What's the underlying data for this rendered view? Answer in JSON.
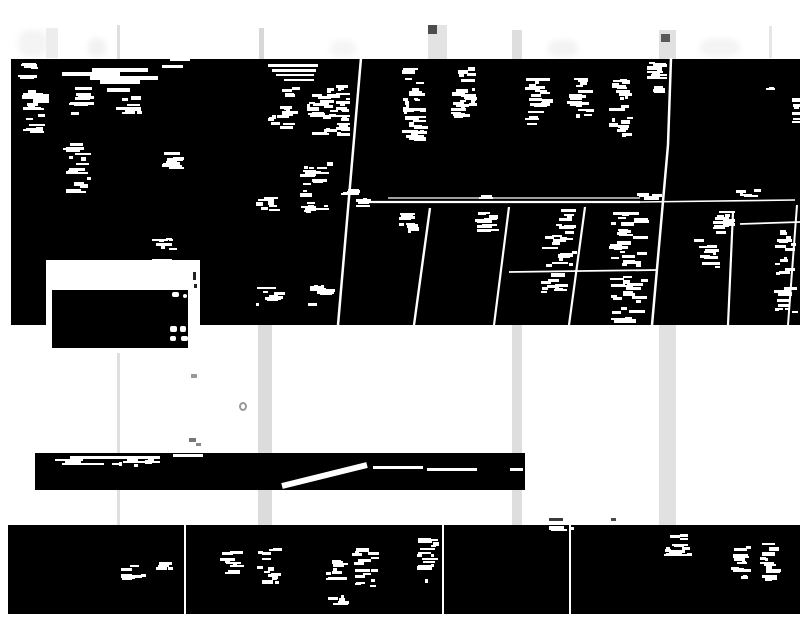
{
  "meta": {
    "description": "Heavily binarized (black and white thresholded) photograph: black bands with illegible white text-remnant speckles, gray vertical poles, a white sign with black panel, slanted white divider lines",
    "width": 800,
    "height": 618
  },
  "palette": {
    "background": "#ffffff",
    "foreground": "#000000",
    "detail": "#ffffff",
    "pole_light": "#e0e0e0",
    "cap_dark": "#4d4d4d"
  },
  "black_blocks": [
    {
      "name": "black-band-main",
      "x": 11,
      "y": 59,
      "w": 789,
      "h": 266
    },
    {
      "name": "black-bar-middle",
      "x": 35,
      "y": 453,
      "w": 490,
      "h": 37
    },
    {
      "name": "black-band-bottom",
      "x": 8,
      "y": 525,
      "w": 792,
      "h": 89
    }
  ],
  "poles": [
    {
      "x": 46,
      "y": 28,
      "w": 12,
      "h": 30,
      "color": "#ededed"
    },
    {
      "x": 117,
      "y": 25,
      "w": 3,
      "h": 589,
      "color": "#dfdfdf"
    },
    {
      "x": 259,
      "y": 28,
      "w": 5,
      "h": 31,
      "color": "#d8d8d8"
    },
    {
      "x": 258,
      "y": 325,
      "w": 14,
      "h": 289,
      "color": "#dcdcdc"
    },
    {
      "x": 428,
      "y": 25,
      "w": 19,
      "h": 34,
      "color": "#e3e3e3"
    },
    {
      "x": 512,
      "y": 30,
      "w": 10,
      "h": 584,
      "color": "#dedede"
    },
    {
      "x": 659,
      "y": 30,
      "w": 17,
      "h": 584,
      "color": "#e1e1e1"
    },
    {
      "x": 769,
      "y": 26,
      "w": 3,
      "h": 32,
      "color": "#e6e6e6"
    }
  ],
  "pole_caps": [
    {
      "x": 428,
      "y": 25,
      "w": 9,
      "h": 9,
      "color": "#4d4d4d"
    },
    {
      "x": 661,
      "y": 34,
      "w": 9,
      "h": 8,
      "color": "#5a5a5a"
    }
  ],
  "smudges": [
    {
      "x": 18,
      "y": 30,
      "w": 30,
      "h": 27,
      "color": "#f4f4f4"
    },
    {
      "x": 88,
      "y": 38,
      "w": 18,
      "h": 19,
      "color": "#f2f2f2"
    },
    {
      "x": 330,
      "y": 40,
      "w": 26,
      "h": 17,
      "color": "#f5f5f5"
    },
    {
      "x": 548,
      "y": 40,
      "w": 30,
      "h": 17,
      "color": "#f3f3f3"
    },
    {
      "x": 700,
      "y": 38,
      "w": 40,
      "h": 19,
      "color": "#f4f4f4"
    }
  ],
  "sign": {
    "panel": {
      "x": 46,
      "y": 260,
      "w": 154,
      "h": 93
    },
    "inner": {
      "x": 52,
      "y": 290,
      "w": 136,
      "h": 58
    },
    "white_glyphs": [
      [
        172,
        292,
        7,
        5
      ],
      [
        183,
        294,
        4,
        4
      ],
      [
        170,
        326,
        7,
        6
      ],
      [
        180,
        326,
        6,
        6
      ],
      [
        170,
        336,
        6,
        5
      ],
      [
        181,
        336,
        7,
        5
      ]
    ],
    "dark_marks": [
      [
        193,
        272,
        3,
        8
      ],
      [
        194,
        284,
        3,
        4
      ]
    ]
  },
  "white_lines": [
    [
      361,
      58,
      338,
      325,
      2.5
    ],
    [
      671,
      58,
      668,
      145,
      2.5
    ],
    [
      668,
      145,
      652,
      325,
      2.5
    ],
    [
      358,
      202,
      640,
      202,
      2.2
    ],
    [
      388,
      198,
      640,
      198,
      1.2
    ],
    [
      640,
      202,
      795,
      200,
      1.6
    ],
    [
      509,
      272,
      657,
      270,
      1.8
    ],
    [
      740,
      224,
      800,
      222,
      1.8
    ],
    [
      430,
      208,
      414,
      325,
      2.4
    ],
    [
      509,
      207,
      494,
      325,
      2.2
    ],
    [
      585,
      207,
      569,
      325,
      2.2
    ],
    [
      733,
      212,
      728,
      325,
      2.2
    ],
    [
      797,
      205,
      788,
      325,
      2.0
    ],
    [
      282,
      486,
      367,
      465,
      6.0
    ],
    [
      185,
      525,
      185,
      614,
      2.0
    ],
    [
      443,
      525,
      443,
      614,
      2.0
    ],
    [
      570,
      525,
      570,
      614,
      2.0
    ]
  ],
  "white_streaks": [
    [
      92,
      68,
      56,
      4
    ],
    [
      62,
      72,
      58,
      4
    ],
    [
      90,
      76,
      68,
      4
    ],
    [
      100,
      80,
      40,
      4
    ],
    [
      75,
      87,
      17,
      3
    ],
    [
      107,
      88,
      23,
      4
    ],
    [
      162,
      65,
      21,
      3
    ],
    [
      170,
      58,
      20,
      3
    ],
    [
      268,
      64,
      50,
      3
    ],
    [
      272,
      69,
      44,
      3
    ],
    [
      276,
      74,
      38,
      2
    ],
    [
      284,
      79,
      30,
      2
    ],
    [
      70,
      456,
      90,
      3
    ],
    [
      55,
      459,
      28,
      2
    ],
    [
      123,
      461,
      37,
      2
    ],
    [
      62,
      463,
      42,
      2
    ],
    [
      173,
      454,
      30,
      3
    ],
    [
      373,
      466,
      50,
      3
    ],
    [
      427,
      468,
      50,
      3
    ],
    [
      510,
      468,
      13,
      3
    ],
    [
      152,
      259,
      20,
      3
    ],
    [
      176,
      261,
      12,
      2
    ],
    [
      150,
      264,
      24,
      2
    ]
  ],
  "speckle_clusters": [
    [
      14,
      62,
      28,
      18,
      9
    ],
    [
      22,
      90,
      27,
      43,
      22
    ],
    [
      68,
      93,
      26,
      27,
      13
    ],
    [
      116,
      94,
      28,
      26,
      13
    ],
    [
      23,
      128,
      25,
      6,
      3
    ],
    [
      63,
      142,
      28,
      52,
      20
    ],
    [
      159,
      151,
      26,
      20,
      9
    ],
    [
      250,
      197,
      30,
      16,
      8
    ],
    [
      300,
      197,
      29,
      16,
      8
    ],
    [
      152,
      235,
      27,
      15,
      8
    ],
    [
      150,
      258,
      26,
      11,
      6
    ],
    [
      255,
      286,
      30,
      21,
      10
    ],
    [
      306,
      284,
      31,
      23,
      10
    ],
    [
      266,
      99,
      33,
      33,
      15
    ],
    [
      282,
      83,
      18,
      15,
      6
    ],
    [
      302,
      85,
      39,
      51,
      24
    ],
    [
      298,
      162,
      35,
      39,
      16
    ],
    [
      336,
      82,
      14,
      54,
      22
    ],
    [
      341,
      188,
      20,
      14,
      7
    ],
    [
      356,
      196,
      15,
      13,
      5
    ],
    [
      402,
      64,
      27,
      79,
      38
    ],
    [
      450,
      67,
      28,
      52,
      26
    ],
    [
      525,
      77,
      28,
      50,
      20
    ],
    [
      567,
      75,
      28,
      44,
      18
    ],
    [
      608,
      77,
      25,
      61,
      24
    ],
    [
      646,
      60,
      22,
      34,
      14
    ],
    [
      766,
      86,
      9,
      5,
      2
    ],
    [
      792,
      92,
      8,
      37,
      8
    ],
    [
      397,
      211,
      22,
      24,
      11
    ],
    [
      475,
      212,
      25,
      20,
      10
    ],
    [
      542,
      209,
      36,
      59,
      24
    ],
    [
      540,
      272,
      32,
      22,
      9
    ],
    [
      608,
      208,
      42,
      60,
      28
    ],
    [
      608,
      275,
      42,
      48,
      26
    ],
    [
      692,
      239,
      32,
      29,
      12
    ],
    [
      712,
      208,
      24,
      26,
      12
    ],
    [
      773,
      230,
      26,
      95,
      28
    ],
    [
      478,
      192,
      15,
      7,
      3
    ],
    [
      636,
      192,
      26,
      9,
      5
    ],
    [
      731,
      189,
      31,
      11,
      6
    ],
    [
      120,
      564,
      26,
      19,
      9
    ],
    [
      152,
      559,
      28,
      11,
      5
    ],
    [
      219,
      549,
      27,
      27,
      11
    ],
    [
      256,
      547,
      28,
      39,
      14
    ],
    [
      320,
      555,
      30,
      27,
      11
    ],
    [
      352,
      545,
      28,
      43,
      15
    ],
    [
      320,
      595,
      30,
      12,
      5
    ],
    [
      416,
      538,
      24,
      47,
      16
    ],
    [
      546,
      524,
      28,
      9,
      5
    ],
    [
      664,
      526,
      28,
      45,
      16
    ],
    [
      729,
      542,
      23,
      38,
      13
    ],
    [
      759,
      542,
      23,
      40,
      13
    ],
    [
      52,
      457,
      112,
      10,
      8
    ]
  ],
  "gray_marks": [
    {
      "type": "ring",
      "x": 239,
      "y": 402,
      "w": 8,
      "h": 9,
      "color": "#999999"
    },
    {
      "type": "wisp",
      "x": 191,
      "y": 374,
      "w": 6,
      "h": 4,
      "color": "#999999"
    },
    {
      "type": "wisp",
      "x": 189,
      "y": 438,
      "w": 7,
      "h": 4,
      "color": "#777777"
    },
    {
      "type": "wisp",
      "x": 196,
      "y": 443,
      "w": 5,
      "h": 3,
      "color": "#888888"
    },
    {
      "type": "dash",
      "x": 549,
      "y": 518,
      "w": 14,
      "h": 3,
      "color": "#3a3a3a"
    },
    {
      "type": "dash",
      "x": 611,
      "y": 518,
      "w": 5,
      "h": 3,
      "color": "#4a4a4a"
    }
  ]
}
